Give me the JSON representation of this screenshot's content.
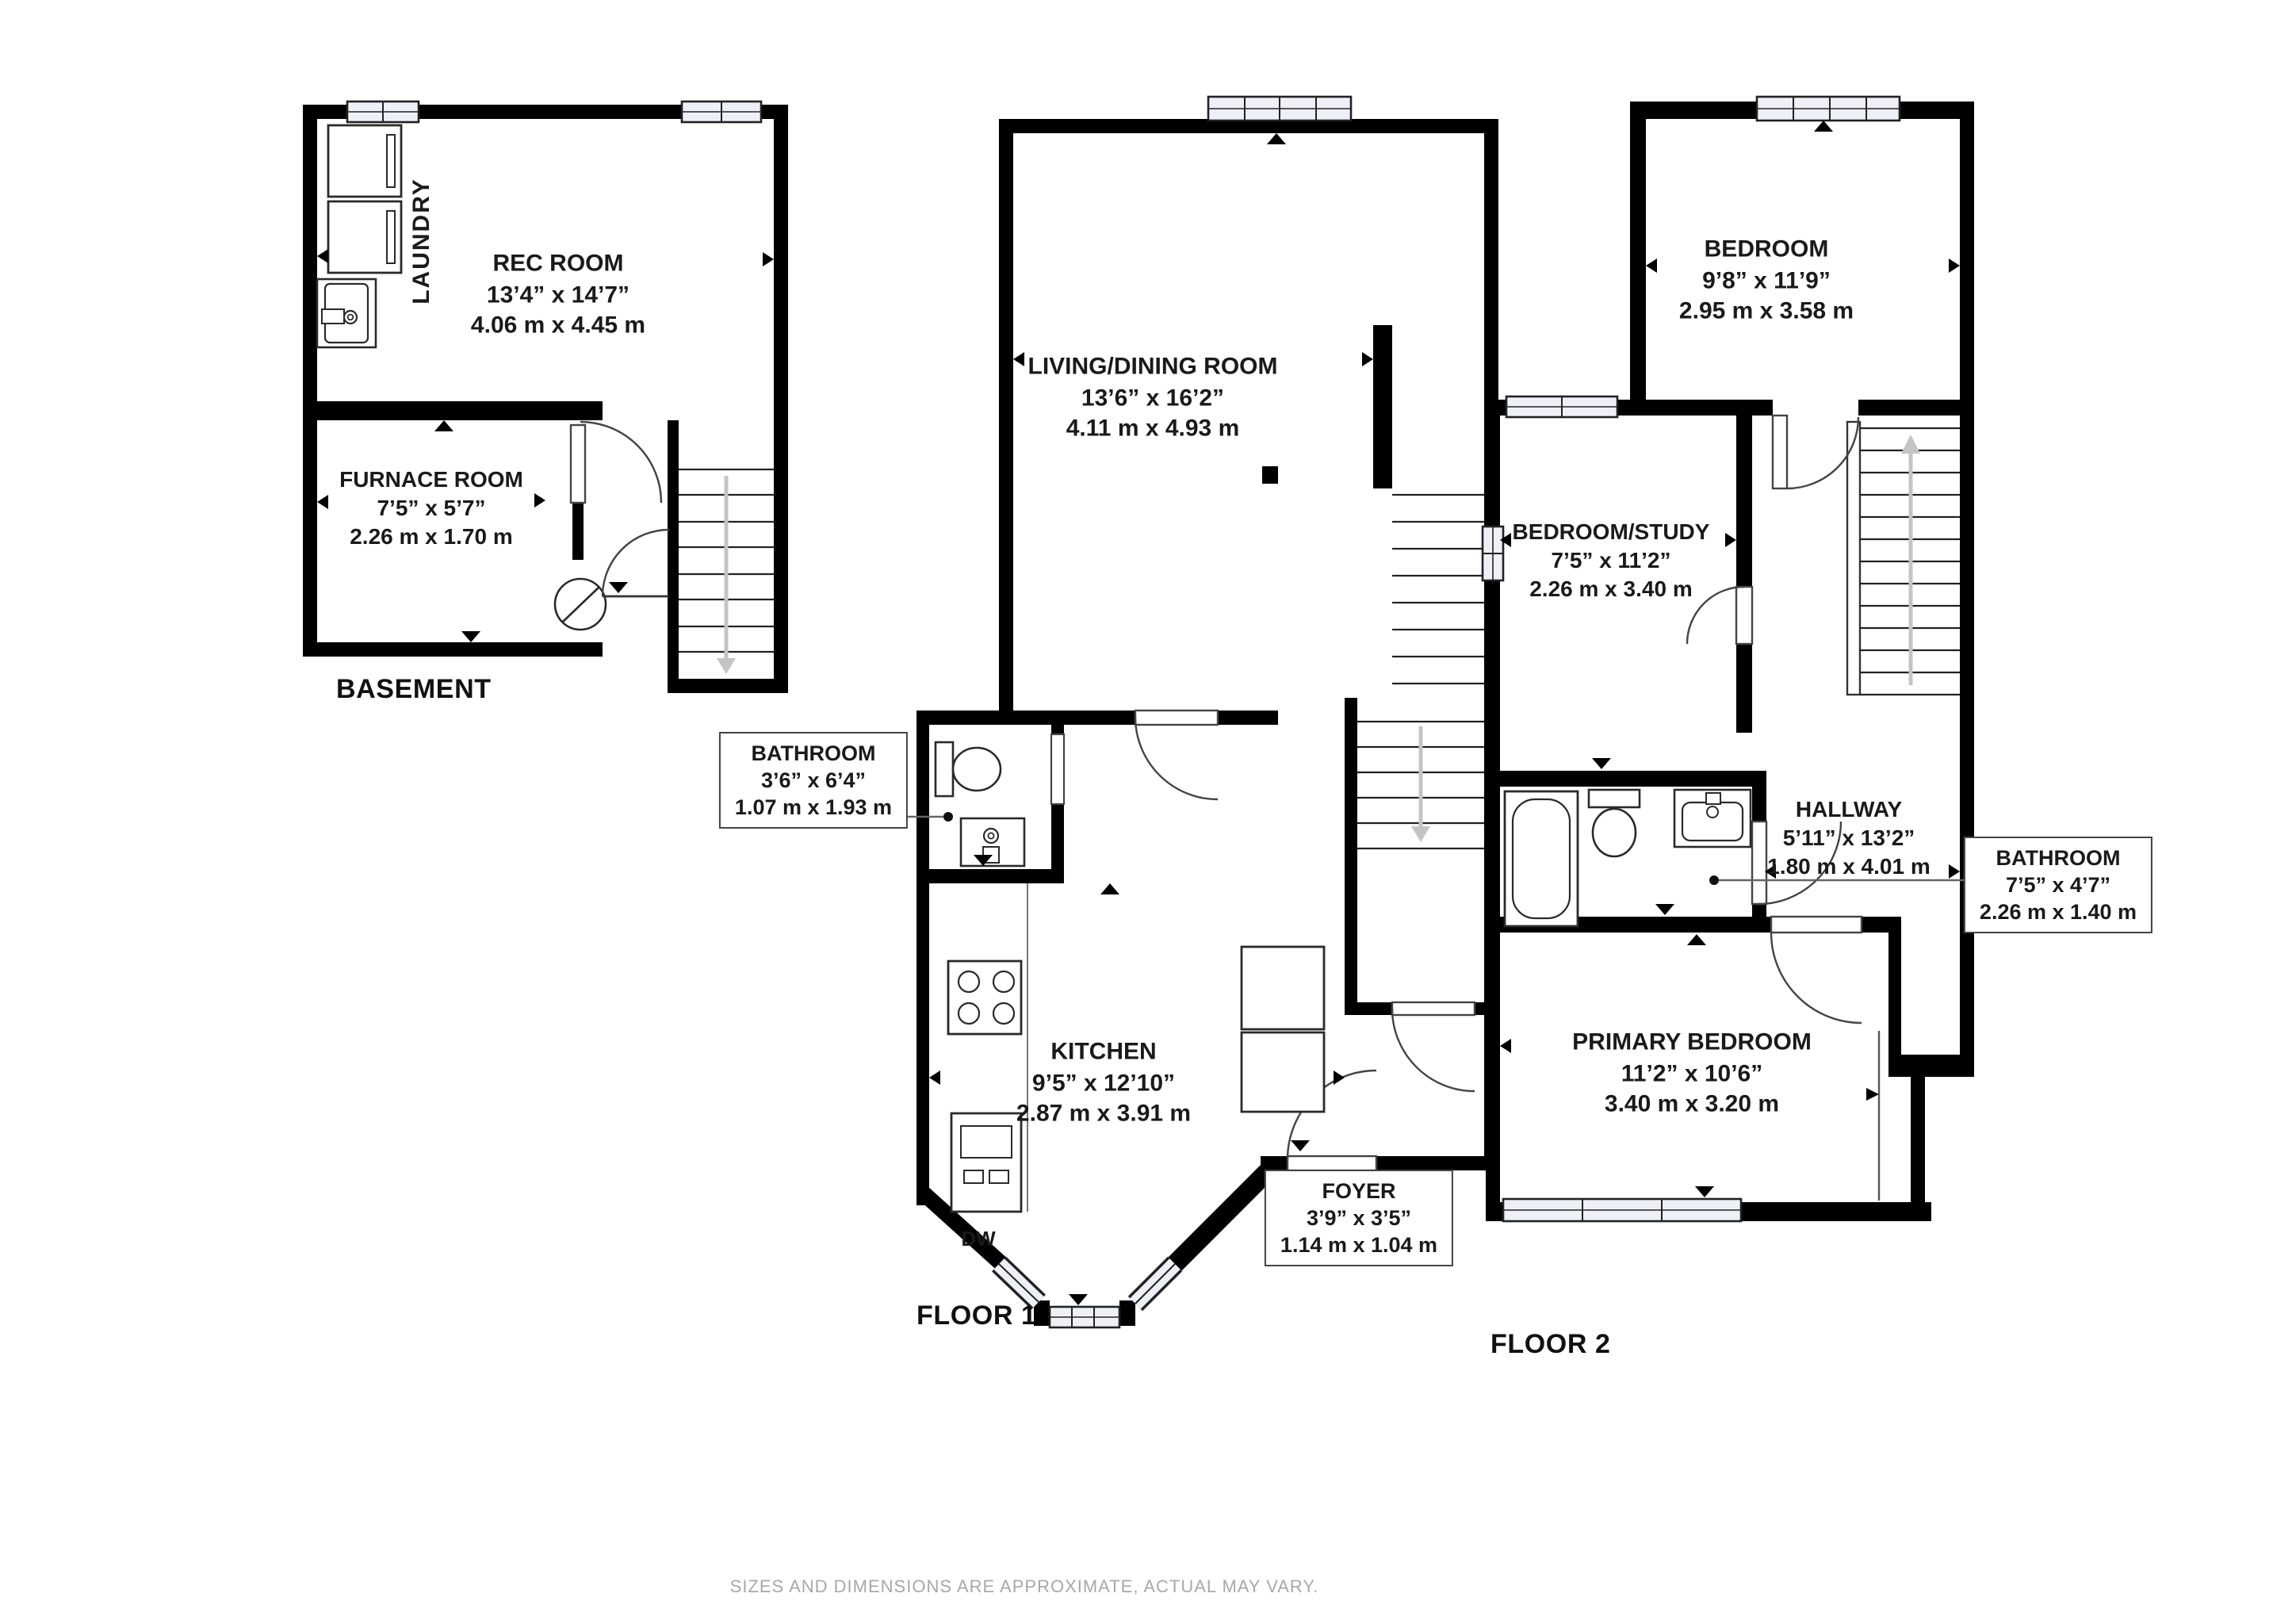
{
  "colors": {
    "wall": "#000000",
    "window_fill": "#eef0f8",
    "stair_arrow": "#c4c4c4",
    "text": "#1a1a1a",
    "muted_text": "#a8a8a8",
    "box_border": "#444444"
  },
  "floors": {
    "basement": {
      "title": "BASEMENT",
      "laundry_label": "LAUNDRY",
      "rooms": {
        "rec_room": {
          "name": "REC ROOM",
          "imperial": "13’4” x 14’7”",
          "metric": "4.06 m x 4.45 m"
        },
        "furnace_room": {
          "name": "FURNACE ROOM",
          "imperial": "7’5” x 5’7”",
          "metric": "2.26 m x 1.70 m"
        }
      }
    },
    "floor1": {
      "title": "FLOOR 1",
      "appliances": {
        "dishwasher": "DW"
      },
      "rooms": {
        "living_dining": {
          "name": "LIVING/DINING ROOM",
          "imperial": "13’6” x 16’2”",
          "metric": "4.11 m x 4.93 m"
        },
        "bathroom": {
          "name": "BATHROOM",
          "imperial": "3’6” x 6’4”",
          "metric": "1.07 m x 1.93 m"
        },
        "kitchen": {
          "name": "KITCHEN",
          "imperial": "9’5” x 12’10”",
          "metric": "2.87 m x 3.91 m"
        },
        "foyer": {
          "name": "FOYER",
          "imperial": "3’9” x 3’5”",
          "metric": "1.14 m x 1.04 m"
        }
      }
    },
    "floor2": {
      "title": "FLOOR 2",
      "rooms": {
        "bedroom": {
          "name": "BEDROOM",
          "imperial": "9’8” x 11’9”",
          "metric": "2.95 m x 3.58 m"
        },
        "bedroom_study": {
          "name": "BEDROOM/STUDY",
          "imperial": "7’5” x 11’2”",
          "metric": "2.26 m x 3.40 m"
        },
        "hallway": {
          "name": "HALLWAY",
          "imperial": "5’11” x 13’2”",
          "metric": "1.80 m x 4.01 m"
        },
        "bathroom": {
          "name": "BATHROOM",
          "imperial": "7’5” x 4’7”",
          "metric": "2.26 m x 1.40 m"
        },
        "primary_bedroom": {
          "name": "PRIMARY BEDROOM",
          "imperial": "11’2” x 10’6”",
          "metric": "3.40 m x 3.20 m"
        }
      }
    }
  },
  "footer": {
    "disclaimer": "SIZES AND DIMENSIONS ARE APPROXIMATE, ACTUAL MAY VARY."
  }
}
